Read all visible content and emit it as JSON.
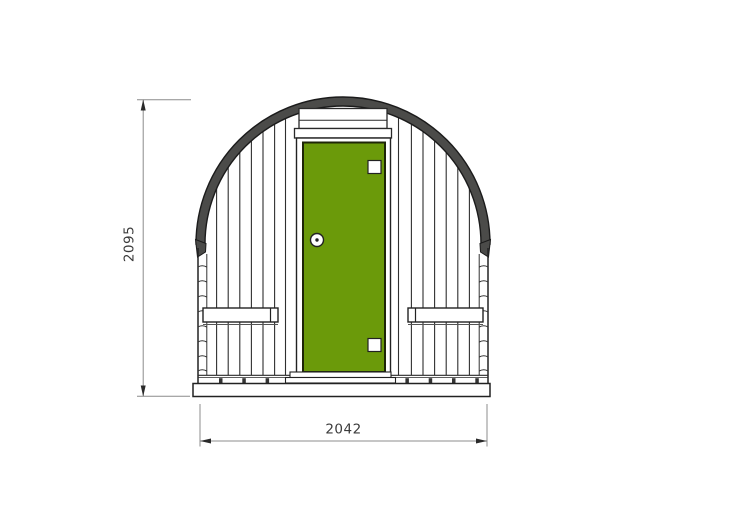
{
  "drawing": {
    "dimensions": {
      "height_label": "2095",
      "width_label": "2042"
    },
    "colors": {
      "door_green": "#6b9a0a",
      "roof_band_dark": "#4b4b49",
      "outline_dark": "#222222",
      "dimension_line_gray": "#8c8c8c",
      "background": "#ffffff"
    },
    "icons": {
      "door_handle": "round-knob",
      "door_hinge": "square-hinge-plate"
    }
  }
}
